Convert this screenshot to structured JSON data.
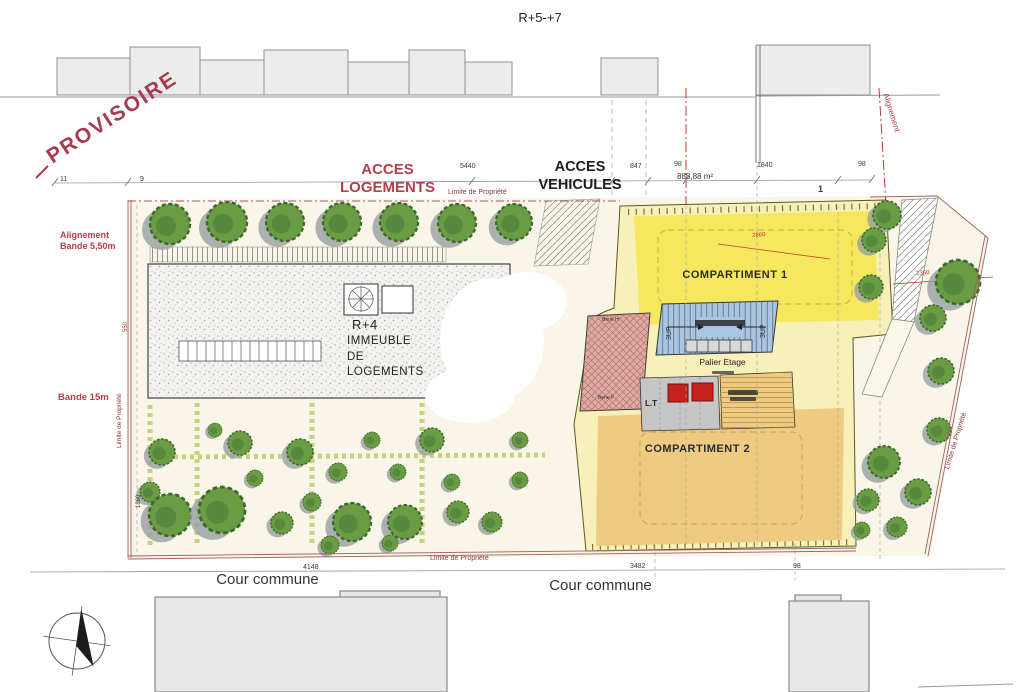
{
  "title": "R+5-+7",
  "annotations": {
    "provisoire": "PROVISOIRE",
    "acces_logements": "ACCES\nLOGEMENTS",
    "acces_vehicules": "ACCES\nVEHICULES",
    "alignement_bande": "Alignement\nBande 5,50m",
    "bande_15m": "Bande 15m",
    "alignement_right": "Alignement",
    "surface": "888,88 m²",
    "limite_de_propriete_top": "Limite de Propriété",
    "limite_de_propriete_left": "Limite de Propriété",
    "limite_de_propriete_right": "Limite de Propriété",
    "limite_de_propriete_bottom": "Limite de Propriété",
    "cour_commune_left": "Cour commune",
    "cour_commune_right": "Cour commune"
  },
  "buildings": {
    "immeuble": {
      "floors": "R+4",
      "name": "IMMEUBLE\nDE\nLOGEMENTS"
    },
    "projet": {
      "compartiment_1": "COMPARTIMENT 1",
      "compartiment_2": "COMPARTIMENT 2",
      "palier_etage": "Palier Etage",
      "local_technique": "L.T",
      "stair_left": "3UP",
      "stair_right": "3UP",
      "local_h": "Bene H",
      "local_f": "Bene F"
    }
  },
  "dimensions": {
    "top": {
      "n11": "11",
      "n9": "9",
      "n5440": "5440",
      "n847": "847",
      "n98a": "98",
      "n1840": "1840",
      "n98b": "98",
      "n1": "1"
    },
    "left": {
      "n550": "550",
      "n1860": "1860"
    },
    "bottom": {
      "n4148": "4148",
      "n3482": "3482",
      "n98": "98"
    },
    "site": {
      "n2860": "2860",
      "n1360": "1360"
    }
  },
  "colors": {
    "annotation_red": "#b3404a",
    "dim_red": "#c0392b",
    "property_line": "#a06060",
    "yellow": "#f6e85e",
    "pale_yellow": "#f7f0b8",
    "tan": "#efcb82",
    "stair_blue": "#a9c5e2",
    "bike_pink": "#dfaaa4",
    "elevator_red": "#c5211d",
    "tree_green": "#6a9c44",
    "parcel_cream": "#f9f5e8"
  }
}
